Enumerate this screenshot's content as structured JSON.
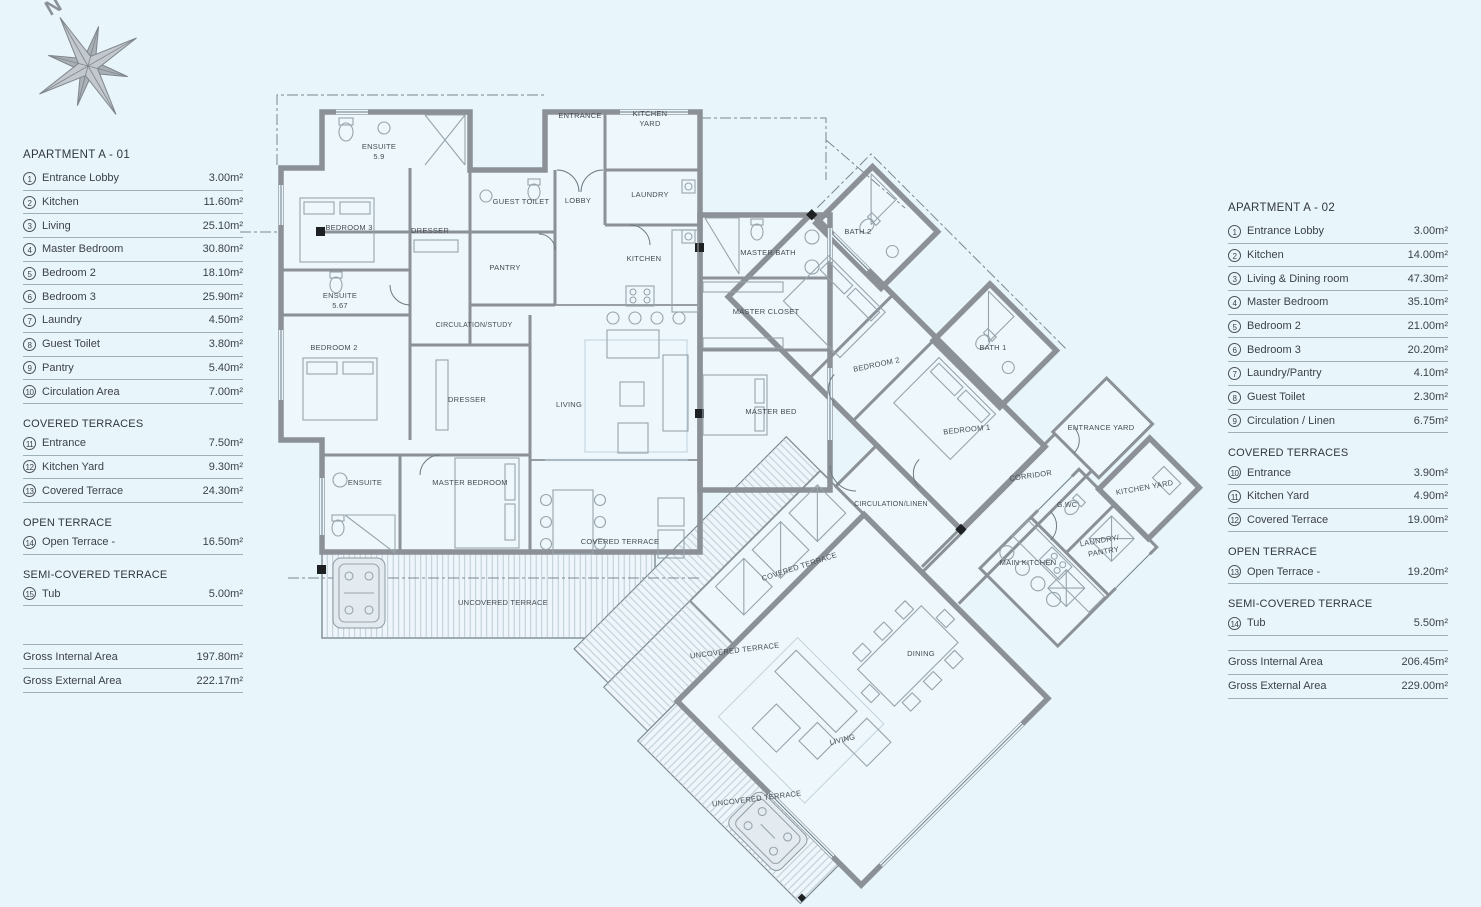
{
  "scene": {
    "background_color": "#e8f5fb",
    "wall_color": "#8b9196",
    "text_color": "#3c4247",
    "deck_line_color": "#bccbd4"
  },
  "compass": {
    "label": "N"
  },
  "legend_left": {
    "title": "APARTMENT A - 01",
    "rows": [
      {
        "num": "1",
        "label": "Entrance Lobby",
        "value": "3.00m²"
      },
      {
        "num": "2",
        "label": "Kitchen",
        "value": "11.60m²"
      },
      {
        "num": "3",
        "label": "Living",
        "value": "25.10m²"
      },
      {
        "num": "4",
        "label": "Master Bedroom",
        "value": "30.80m²"
      },
      {
        "num": "5",
        "label": "Bedroom 2",
        "value": "18.10m²"
      },
      {
        "num": "6",
        "label": "Bedroom 3",
        "value": "25.90m²"
      },
      {
        "num": "7",
        "label": "Laundry",
        "value": "4.50m²"
      },
      {
        "num": "8",
        "label": "Guest Toilet",
        "value": "3.80m²"
      },
      {
        "num": "9",
        "label": "Pantry",
        "value": "5.40m²"
      },
      {
        "num": "10",
        "label": "Circulation Area",
        "value": "7.00m²"
      }
    ],
    "sections": [
      {
        "header": "COVERED TERRACES",
        "rows": [
          {
            "num": "11",
            "label": "Entrance",
            "value": "7.50m²"
          },
          {
            "num": "12",
            "label": "Kitchen Yard",
            "value": "9.30m²"
          },
          {
            "num": "13",
            "label": "Covered Terrace",
            "value": "24.30m²"
          }
        ]
      },
      {
        "header": "OPEN TERRACE",
        "rows": [
          {
            "num": "14",
            "label": "Open Terrace -",
            "value": "16.50m²"
          }
        ]
      },
      {
        "header": "SEMI-COVERED TERRACE",
        "rows": [
          {
            "num": "15",
            "label": "Tub",
            "value": "5.00m²"
          }
        ]
      }
    ],
    "totals": [
      {
        "label": "Gross Internal Area",
        "value": "197.80m²"
      },
      {
        "label": "Gross External Area",
        "value": "222.17m²"
      }
    ]
  },
  "legend_right": {
    "title": "APARTMENT A - 02",
    "rows": [
      {
        "num": "1",
        "label": "Entrance Lobby",
        "value": "3.00m²"
      },
      {
        "num": "2",
        "label": "Kitchen",
        "value": "14.00m²"
      },
      {
        "num": "3",
        "label": "Living & Dining room",
        "value": "47.30m²"
      },
      {
        "num": "4",
        "label": "Master Bedroom",
        "value": "35.10m²"
      },
      {
        "num": "5",
        "label": "Bedroom 2",
        "value": "21.00m²"
      },
      {
        "num": "6",
        "label": "Bedroom 3",
        "value": "20.20m²"
      },
      {
        "num": "7",
        "label": "Laundry/Pantry",
        "value": "4.10m²"
      },
      {
        "num": "8",
        "label": "Guest Toilet",
        "value": "2.30m²"
      },
      {
        "num": "9",
        "label": "Circulation / Linen",
        "value": "6.75m²"
      }
    ],
    "sections": [
      {
        "header": "COVERED TERRACES",
        "rows": [
          {
            "num": "10",
            "label": "Entrance",
            "value": "3.90m²"
          },
          {
            "num": "11",
            "label": "Kitchen Yard",
            "value": "4.90m²"
          },
          {
            "num": "12",
            "label": "Covered Terrace",
            "value": "19.00m²"
          }
        ]
      },
      {
        "header": "OPEN TERRACE",
        "rows": [
          {
            "num": "13",
            "label": "Open Terrace -",
            "value": "19.20m²"
          }
        ]
      },
      {
        "header": "SEMI-COVERED TERRACE",
        "rows": [
          {
            "num": "14",
            "label": "Tub",
            "value": "5.50m²"
          }
        ]
      }
    ],
    "totals": [
      {
        "label": "Gross Internal Area",
        "value": "206.45m²"
      },
      {
        "label": "Gross External Area",
        "value": "229.00m²"
      }
    ]
  },
  "plan": {
    "labels": [
      {
        "t": "ENSUITE",
        "x": 379,
        "y": 149
      },
      {
        "t": "5.9",
        "x": 379,
        "y": 159
      },
      {
        "t": "ENTRANCE",
        "x": 580,
        "y": 118
      },
      {
        "t": "KITCHEN",
        "x": 650,
        "y": 116
      },
      {
        "t": "YARD",
        "x": 650,
        "y": 126
      },
      {
        "t": "GUEST TOILET",
        "x": 521,
        "y": 204
      },
      {
        "t": "LOBBY",
        "x": 578,
        "y": 203
      },
      {
        "t": "LAUNDRY",
        "x": 650,
        "y": 197
      },
      {
        "t": "KITCHEN",
        "x": 644,
        "y": 261
      },
      {
        "t": "PANTRY",
        "x": 505,
        "y": 270
      },
      {
        "t": "BEDROOM 3",
        "x": 349,
        "y": 230
      },
      {
        "t": "DRESSER",
        "x": 430,
        "y": 233
      },
      {
        "t": "ENSUITE",
        "x": 340,
        "y": 298
      },
      {
        "t": "5.67",
        "x": 340,
        "y": 308
      },
      {
        "t": "BEDROOM 2",
        "x": 334,
        "y": 350
      },
      {
        "t": "CIRCULATION/STUDY",
        "x": 474,
        "y": 327,
        "s": 7
      },
      {
        "t": "DRESSER",
        "x": 467,
        "y": 402
      },
      {
        "t": "LIVING",
        "x": 569,
        "y": 407
      },
      {
        "t": "ENSUITE",
        "x": 365,
        "y": 485
      },
      {
        "t": "MASTER BEDROOM",
        "x": 470,
        "y": 485
      },
      {
        "t": "MASTER BATH",
        "x": 768,
        "y": 255
      },
      {
        "t": "MASTER CLOSET",
        "x": 766,
        "y": 314
      },
      {
        "t": "MASTER BED",
        "x": 771,
        "y": 414
      },
      {
        "t": "COVERED TERRACE",
        "x": 620,
        "y": 544
      },
      {
        "t": "UNCOVERED TERRACE",
        "x": 503,
        "y": 605
      },
      {
        "t": "BATH 2",
        "x": 858,
        "y": 234
      },
      {
        "t": "BEDROOM 2",
        "x": 877,
        "y": 367,
        "r": -12
      },
      {
        "t": "BATH 1",
        "x": 993,
        "y": 350
      },
      {
        "t": "BEDROOM 1",
        "x": 967,
        "y": 432,
        "r": -6
      },
      {
        "t": "ENTRANCE YARD",
        "x": 1101,
        "y": 430
      },
      {
        "t": "CORRIDOR",
        "x": 1031,
        "y": 478,
        "r": -8
      },
      {
        "t": "CIRCULATION/LINEN",
        "x": 891,
        "y": 506,
        "s": 7
      },
      {
        "t": "G.WC",
        "x": 1067,
        "y": 507,
        "s": 7
      },
      {
        "t": "KITCHEN YARD",
        "x": 1145,
        "y": 490,
        "r": -10
      },
      {
        "t": "LAUNDRY/",
        "x": 1100,
        "y": 543,
        "r": -10
      },
      {
        "t": "PANTRY",
        "x": 1104,
        "y": 554,
        "r": -10
      },
      {
        "t": "MAIN KITCHEN",
        "x": 1028,
        "y": 565
      },
      {
        "t": "COVERED TERRACE",
        "x": 800,
        "y": 569,
        "r": -18
      },
      {
        "t": "DINING",
        "x": 921,
        "y": 656
      },
      {
        "t": "LIVING",
        "x": 843,
        "y": 742,
        "r": -14
      },
      {
        "t": "UNCOVERED TERRACE",
        "x": 735,
        "y": 653,
        "r": -7
      },
      {
        "t": "UNCOVERED TERRACE",
        "x": 757,
        "y": 801,
        "r": -7
      }
    ]
  }
}
